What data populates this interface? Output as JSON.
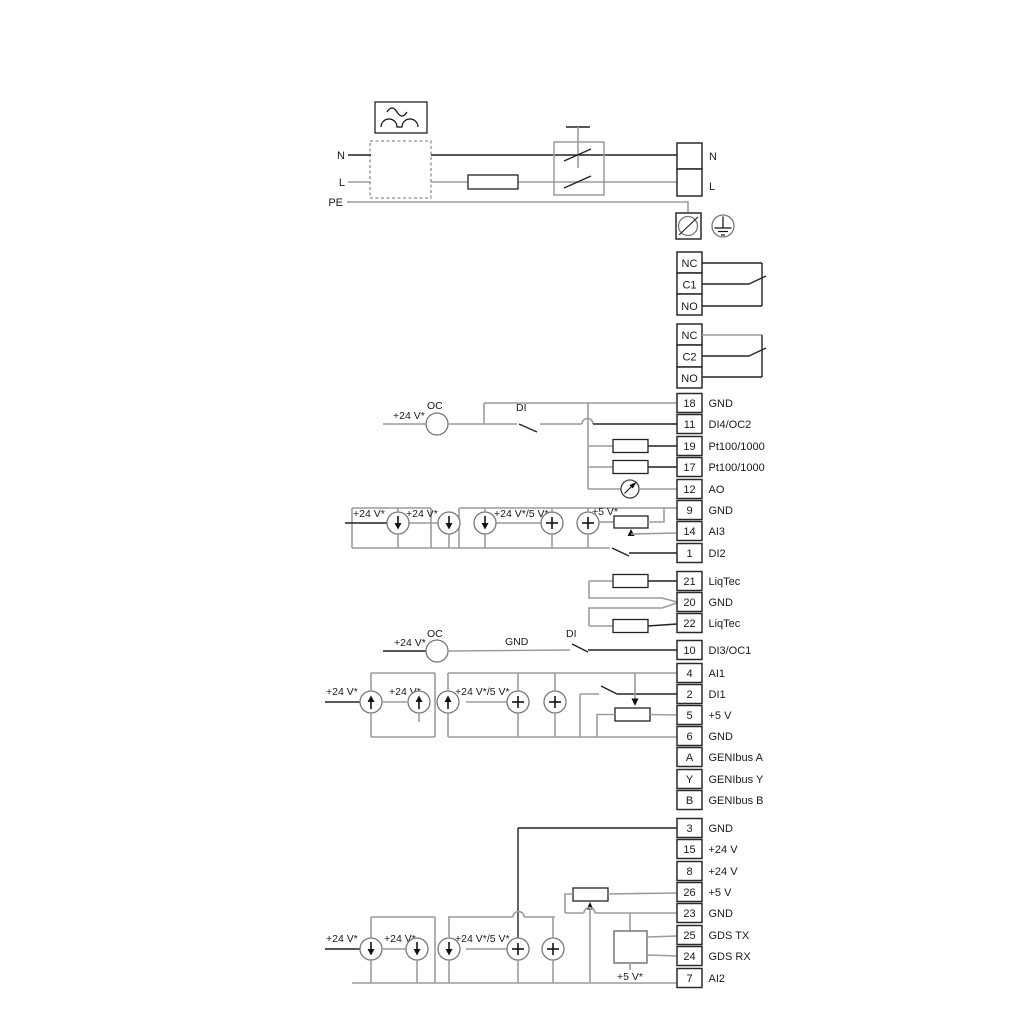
{
  "power": {
    "n_left": "N",
    "l_left": "L",
    "pe": "PE",
    "n_right": "N",
    "l_right": "L"
  },
  "relay1": {
    "nc": "NC",
    "c": "C1",
    "no": "NO"
  },
  "relay2": {
    "nc": "NC",
    "c": "C2",
    "no": "NO"
  },
  "labels": {
    "v24": "+24 V*",
    "v24_5": "+24 V*/5 V*",
    "v5": "+5 V*",
    "oc": "OC",
    "di": "DI",
    "gnd": "GND"
  },
  "terminals": [
    {
      "id": "18",
      "label": "GND"
    },
    {
      "id": "11",
      "label": "DI4/OC2"
    },
    {
      "id": "19",
      "label": "Pt100/1000"
    },
    {
      "id": "17",
      "label": "Pt100/1000"
    },
    {
      "id": "12",
      "label": "AO"
    },
    {
      "id": "9",
      "label": "GND"
    },
    {
      "id": "14",
      "label": "AI3"
    },
    {
      "id": "1",
      "label": "DI2"
    },
    {
      "id": "21",
      "label": "LiqTec"
    },
    {
      "id": "20",
      "label": "GND"
    },
    {
      "id": "22",
      "label": "LiqTec"
    },
    {
      "id": "10",
      "label": "DI3/OC1"
    },
    {
      "id": "4",
      "label": "AI1"
    },
    {
      "id": "2",
      "label": "DI1"
    },
    {
      "id": "5",
      "label": "+5 V"
    },
    {
      "id": "6",
      "label": "GND"
    },
    {
      "id": "A",
      "label": "GENIbus A"
    },
    {
      "id": "Y",
      "label": "GENIbus Y"
    },
    {
      "id": "B",
      "label": "GENIbus B"
    },
    {
      "id": "3",
      "label": "GND"
    },
    {
      "id": "15",
      "label": "+24 V"
    },
    {
      "id": "8",
      "label": "+24 V"
    },
    {
      "id": "26",
      "label": "+5 V"
    },
    {
      "id": "23",
      "label": "GND"
    },
    {
      "id": "25",
      "label": "GDS TX"
    },
    {
      "id": "24",
      "label": "GDS RX"
    },
    {
      "id": "7",
      "label": "AI2"
    }
  ]
}
